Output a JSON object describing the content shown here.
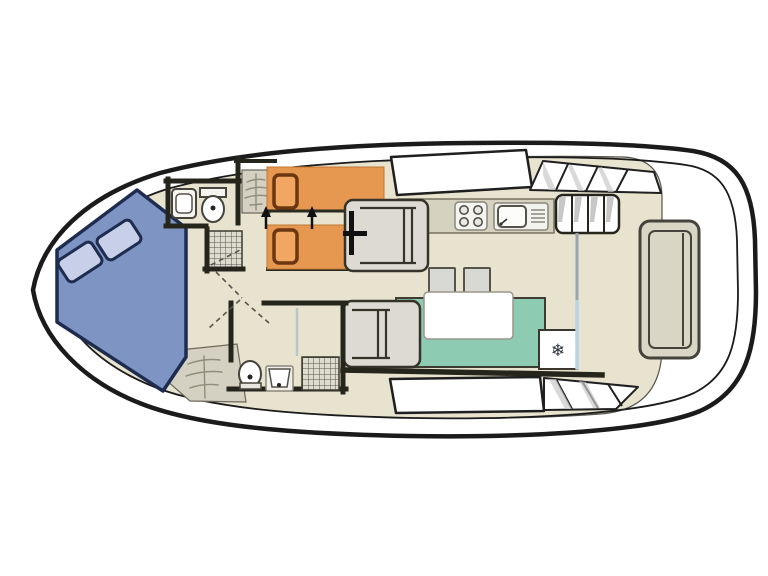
{
  "plan": {
    "type": "boat-deck-floorplan",
    "orientation": "bow-left",
    "regions": {
      "bow_cabin": {
        "label": "v-berth-cabin",
        "bed": "double-v-berth",
        "pillow_count": 2
      },
      "fore_bathroom": {
        "label": "fore-bathroom",
        "fixtures": [
          "washbasin",
          "toilet",
          "shower"
        ]
      },
      "twin_cabin": {
        "label": "twin-bed-cabin",
        "beds": 2,
        "joinable_arrows": 2
      },
      "helm": {
        "label": "helm-station",
        "fixtures": [
          "steering-wheel",
          "helm-seat"
        ]
      },
      "galley": {
        "label": "galley",
        "fixtures": [
          "four-burner-hob",
          "sink-with-drainer"
        ]
      },
      "saloon": {
        "label": "saloon",
        "fixtures": [
          "bench-seat",
          "table",
          "stool",
          "stool",
          "fridge"
        ]
      },
      "aft_bathroom": {
        "label": "aft-bathroom",
        "fixtures": [
          "toilet",
          "washbasin",
          "shower"
        ]
      },
      "aft_deck": {
        "label": "aft-deck",
        "fixtures": [
          "stern-bench",
          "sliding-door",
          "side-steps"
        ]
      }
    },
    "icons": {
      "fridge_snowflake": "❄",
      "bed_join_arrow": "up-arrow",
      "steps_glyph": "ladder-branches",
      "shower_glyph": "crosshatch"
    }
  },
  "colors": {
    "hull_line": "#1b1b1b",
    "deck_white": "#ffffff",
    "floor": "#e7e3cf",
    "counter": "#d6d2c0",
    "wall": "#26251c",
    "vberth_fill": "#7e95c3",
    "vberth_outline": "#1e2c50",
    "vberth_pillow": "#c7d0e8",
    "bed_orange": "#e69750",
    "bed_pillow": "#f1a761",
    "bed_pillow_outline": "#6b3710",
    "bench_green": "#8ecbb3",
    "seat_gray": "#dcdad2",
    "steps_gray": "#d4d1c3",
    "hatch_bg": "#dedbcf",
    "stool_gray": "#d8d8d4",
    "table_white": "#ffffff",
    "fridge_white": "#ffffff",
    "divider_gray": "#9aa4ad",
    "door_blue": "#b9d3e7"
  }
}
